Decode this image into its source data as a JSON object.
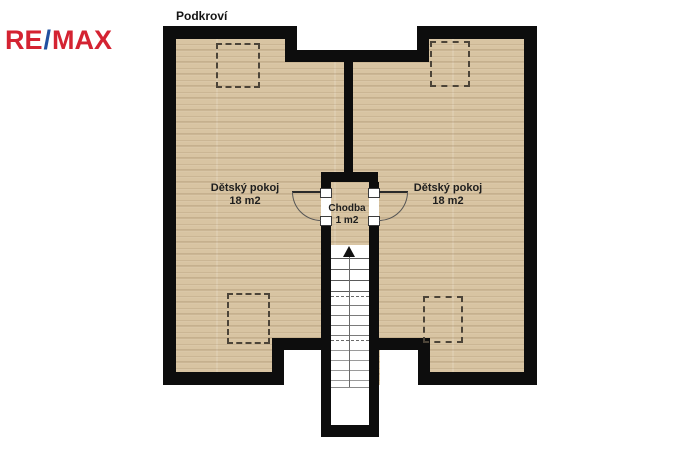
{
  "brand": {
    "re": "RE",
    "slash": "/",
    "max": "MAX",
    "red": "#d42332",
    "blue": "#2150a0"
  },
  "floor_plan": {
    "title": "Podkroví",
    "rooms": [
      {
        "name": "Dětský pokoj",
        "area": "18 m2",
        "position": "left"
      },
      {
        "name": "Dětský pokoj",
        "area": "18 m2",
        "position": "right"
      },
      {
        "name": "Chodba",
        "area": "1 m2",
        "position": "center"
      }
    ],
    "skylight_outline_count": 4,
    "door_count": 2,
    "stairs": {
      "direction": "up",
      "upper_solid_steps": 4,
      "mid_steps": 4,
      "lower_steps": 4,
      "upper_offsets": [
        13,
        24,
        35,
        46
      ],
      "mid_offsets": [
        60,
        70,
        80,
        90
      ],
      "lower_offsets": [
        105,
        115,
        125,
        135
      ],
      "break_line_offsets": [
        51,
        95
      ],
      "separator_offset": 142
    },
    "colors": {
      "wall": "#0d0d0d",
      "floor": "#d8c4a2",
      "background": "#ffffff"
    }
  }
}
